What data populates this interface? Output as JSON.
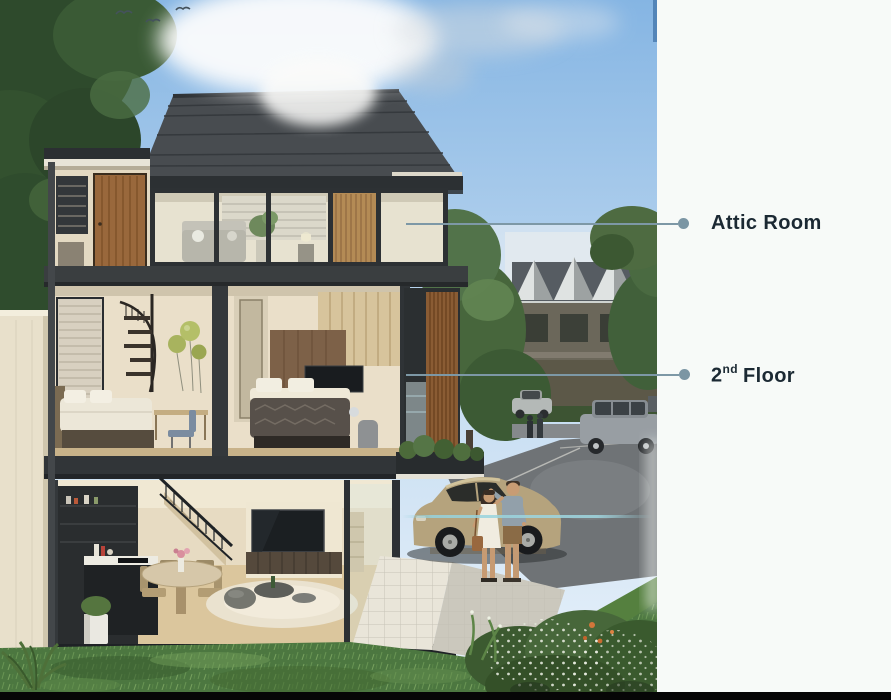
{
  "panel": {
    "attic_label": "Attic Room",
    "floor2_number": "2",
    "floor2_ordinal": "nd",
    "floor2_label": "Floor"
  },
  "colors": {
    "label_text": "#1b2933",
    "leader_line": "#7d98a6",
    "leader_line_faint": "#9fd0d8",
    "panel_background": "#f7faf8",
    "top_accent_line": "#4e80b3",
    "bottom_bar": "#060606",
    "sky": "#8fbbe6",
    "roof": "#484c50",
    "grass": "#4c7740",
    "car_body": "#b5a37d"
  },
  "scene": {
    "illustration": "three-storey-house-cutaway-render",
    "parts": [
      "attic-room",
      "second-floor-bedrooms",
      "first-floor-living-kitchen",
      "garden-lawn",
      "driveway-car-people",
      "neighbour-townhouses"
    ]
  }
}
